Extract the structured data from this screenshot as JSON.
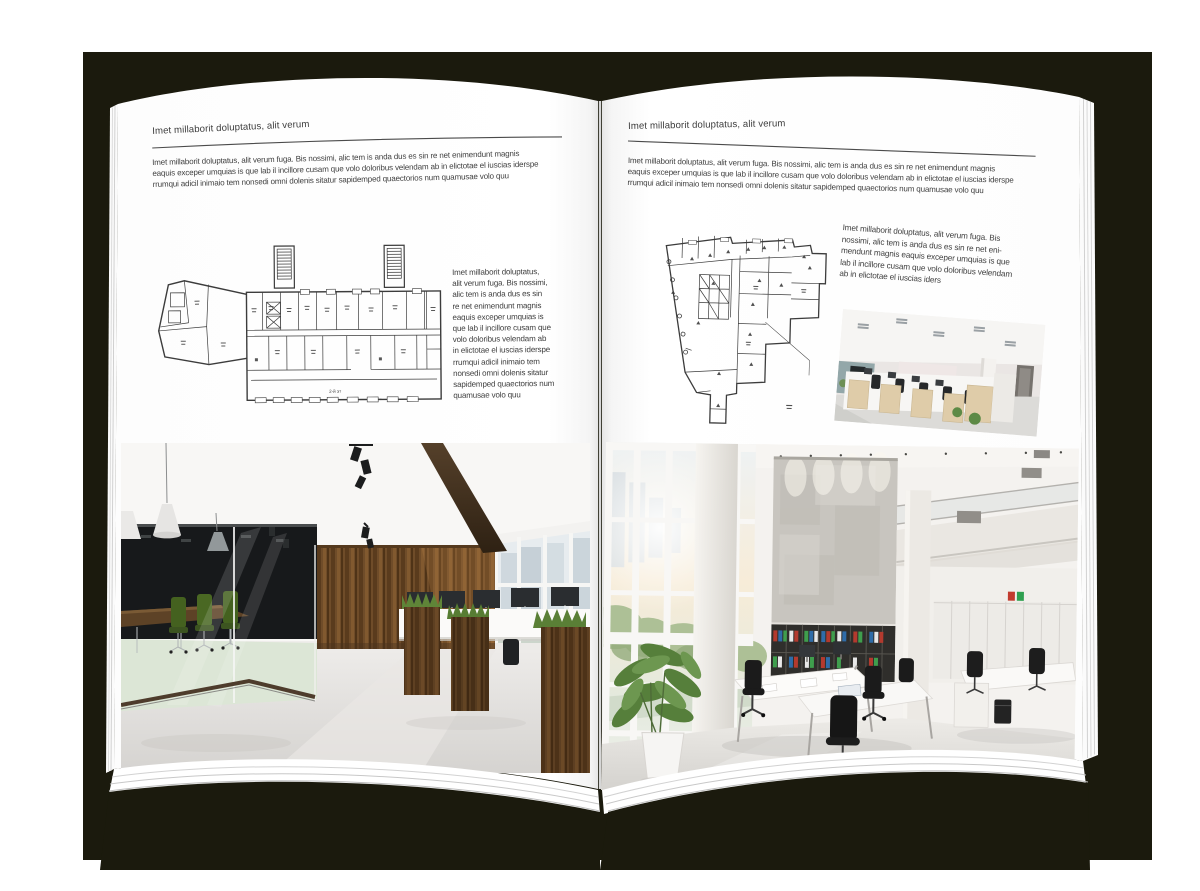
{
  "backdrop_color": "#1b1a0d",
  "book": {
    "left_page": {
      "header": "Imet millaborit doluptatus, alit verum",
      "intro_lines": [
        "Imet millaborit doluptatus, alit verum fuga. Bis nossimi, alic tem is anda dus es sin re net enimendunt magnis",
        "eaquis exceper umquias is que lab il incillore cusam que volo doloribus velendam ab in elictotae el iuscias iderspe",
        "rrumqui adicil inimaio tem nonsedi omni dolenis sitatur sapidemped quaectorios num quamusae volo quu"
      ],
      "side_text_lines": [
        "Imet millaborit doluptatus,",
        "alit verum fuga. Bis nossimi,",
        "alic tem is anda dus es sin",
        "re net enimendunt magnis",
        "eaquis exceper umquias is",
        "que lab il incillore cusam que",
        "volo doloribus velendam ab",
        "in elictotae el iuscias iderspe",
        "rrumqui adicil inimaio tem",
        "nonsedi omni dolenis sitatur",
        "sapidemped quaectorios num",
        "quamusae volo quu"
      ],
      "floor_plan_label": "2-й эт",
      "photo_description": "office interior with glass meeting room, green chairs and wood panel wall"
    },
    "right_page": {
      "header": "Imet millaborit doluptatus, alit verum",
      "intro_lines": [
        "Imet millaborit doluptatus, alit verum fuga. Bis nossimi, alic tem is anda dus es sin re net enimendunt magnis",
        "eaquis exceper umquias is que lab il incillore cusam que volo doloribus velendam ab in elictotae el iuscias iderspe",
        "rrumqui adicil inimaio tem nonsedi omni dolenis sitatur sapidemped quaectorios num quamusae volo quu"
      ],
      "side_text_lines": [
        "Imet millaborit doluptatus, alit verum fuga. Bis",
        "nossimi, alic tem is anda dus es sin re net eni-",
        "mendunt magnis eaquis exceper umquias is que",
        "lab il incillore cusam que volo doloribus velendam",
        "ab in elictotae el iuscias iders"
      ],
      "small_photo_description": "open-plan office with light wood workstations and black chairs",
      "photo_description": "bright double-height office atrium with panoramic windows, concrete wall, binder shelves and white desks"
    }
  },
  "palette": {
    "page_white": "#ffffff",
    "text_gray": "#3f3f3f",
    "rule_gray": "#4b4b4b",
    "plan_ink": "#3c3c3c",
    "wood_brown": "#6f4c29",
    "chair_green": "#44611f",
    "binder_red": "#b33a2e",
    "binder_blue": "#2f6ca8",
    "binder_green": "#3f9e4d"
  }
}
